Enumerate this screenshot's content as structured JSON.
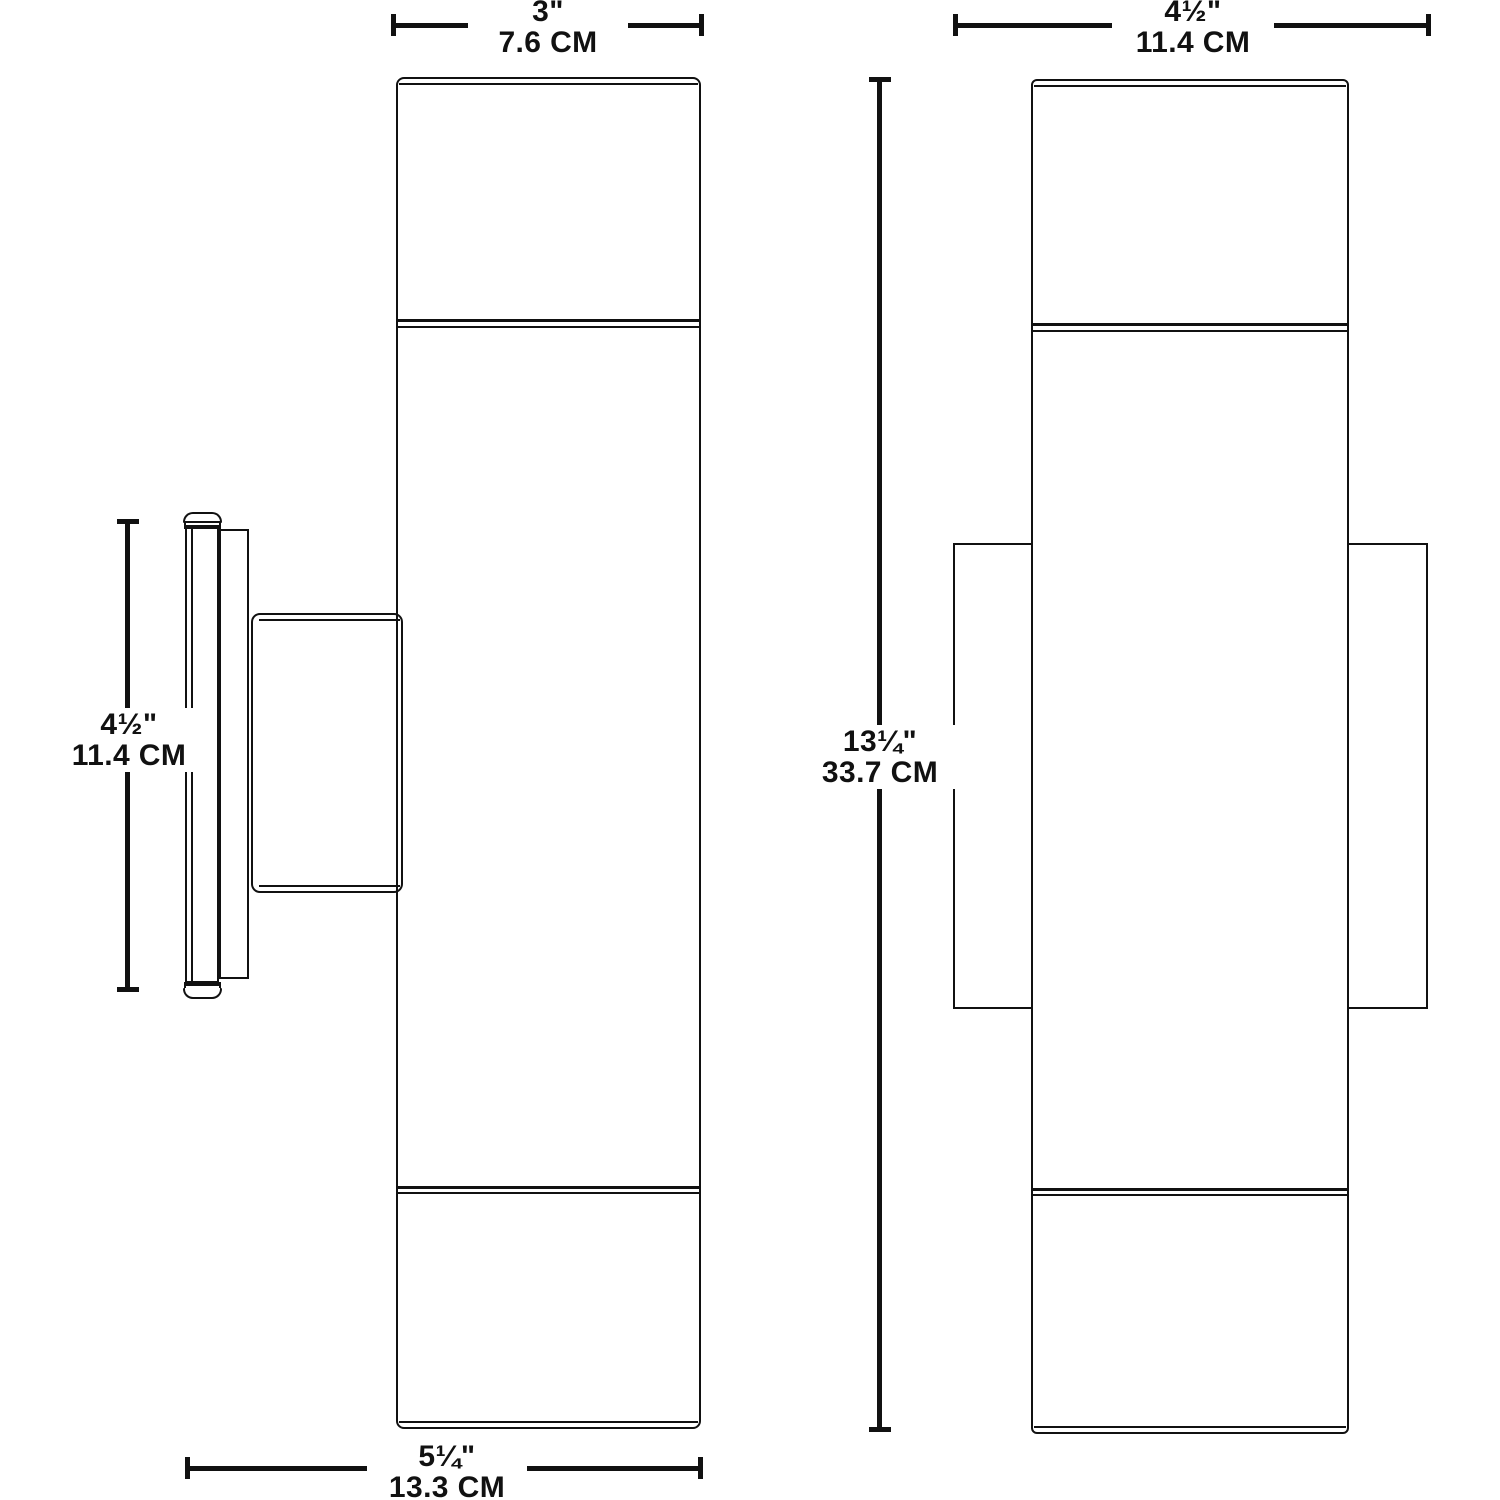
{
  "diagram": {
    "background": "#ffffff",
    "line_color": "#111111"
  },
  "dimensions": {
    "side_width": {
      "inches": "3\"",
      "metric": "7.6 CM"
    },
    "front_width": {
      "inches": "4½\"",
      "metric": "11.4 CM"
    },
    "plate_height": {
      "inches": "4½\"",
      "metric": "11.4 CM"
    },
    "overall_height": {
      "inches": "13¼\"",
      "metric": "33.7 CM"
    },
    "depth": {
      "inches": "5¼\"",
      "metric": "13.3 CM"
    }
  }
}
